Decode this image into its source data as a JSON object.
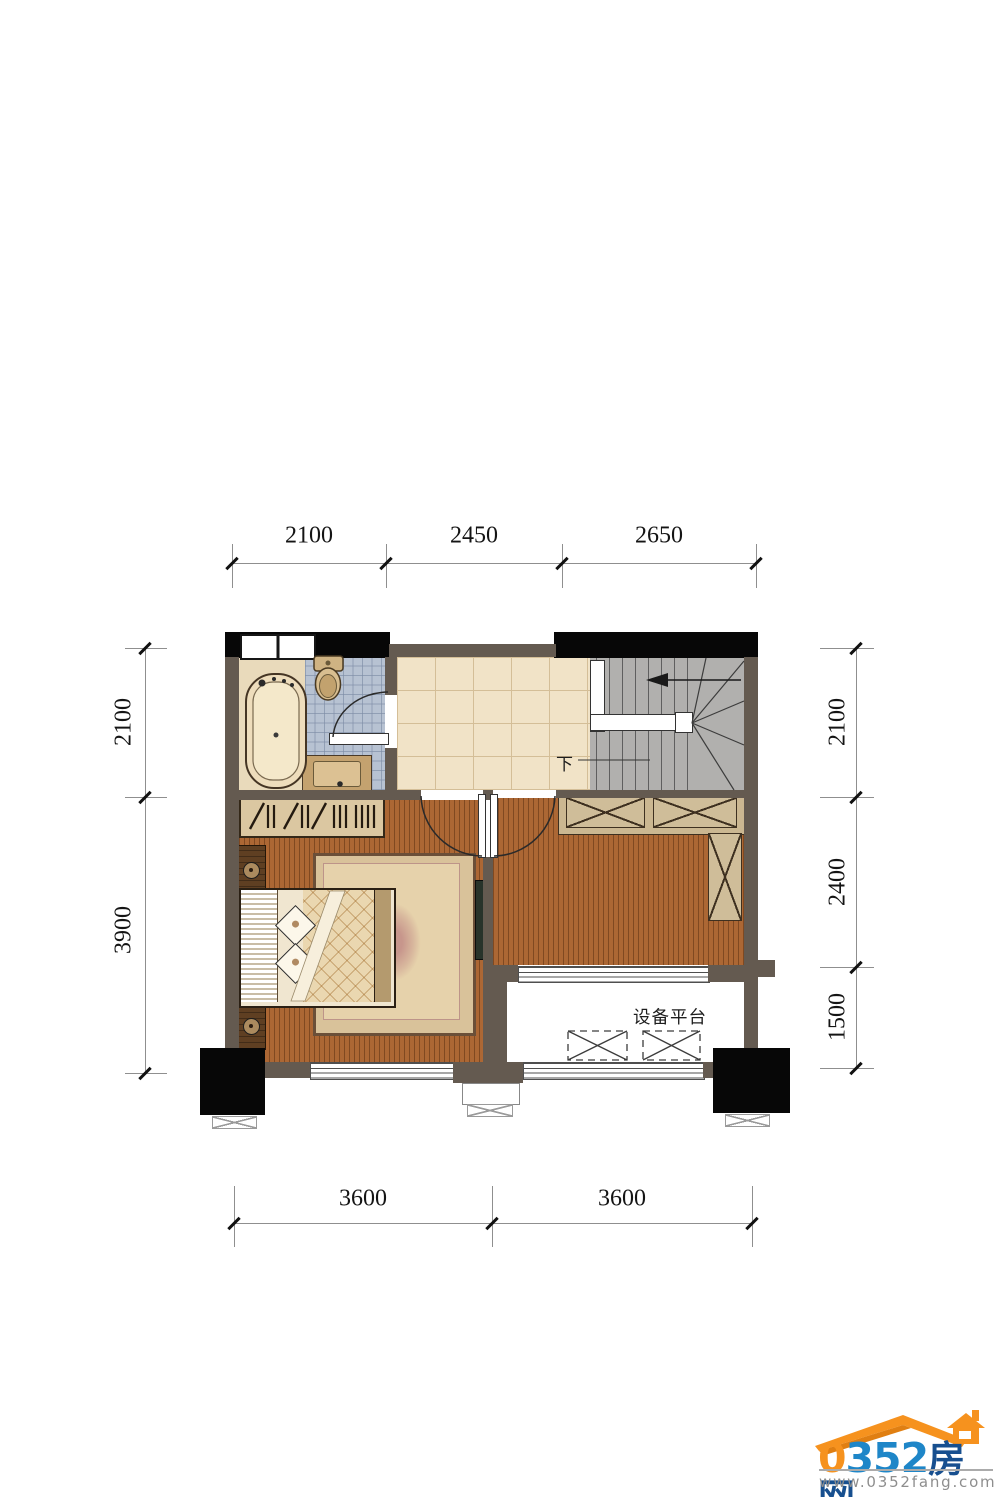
{
  "dimensions": {
    "top": [
      "2100",
      "2450",
      "2650"
    ],
    "bottom": [
      "3600",
      "3600"
    ],
    "left": [
      "2100",
      "3900"
    ],
    "right": [
      "2100",
      "2400",
      "1500"
    ]
  },
  "labels": {
    "stair_down": "下",
    "equipment_platform": "设备平台"
  },
  "logo": {
    "zero": "0",
    "digits": "352",
    "cn": "房网",
    "website": "www.0352fang.com"
  },
  "colors": {
    "wall": "#645a50",
    "column": "#070707",
    "wood_floor": "#ac6734",
    "bath_tile": "#b7c2d2",
    "hall_tile": "#f1e3c7",
    "stair_gray": "#b1b0ae",
    "cabinet": "#cbb791",
    "logo_orange": "#f6921e",
    "logo_blue": "#1e86c8",
    "url_gray": "#8e8e8e"
  }
}
